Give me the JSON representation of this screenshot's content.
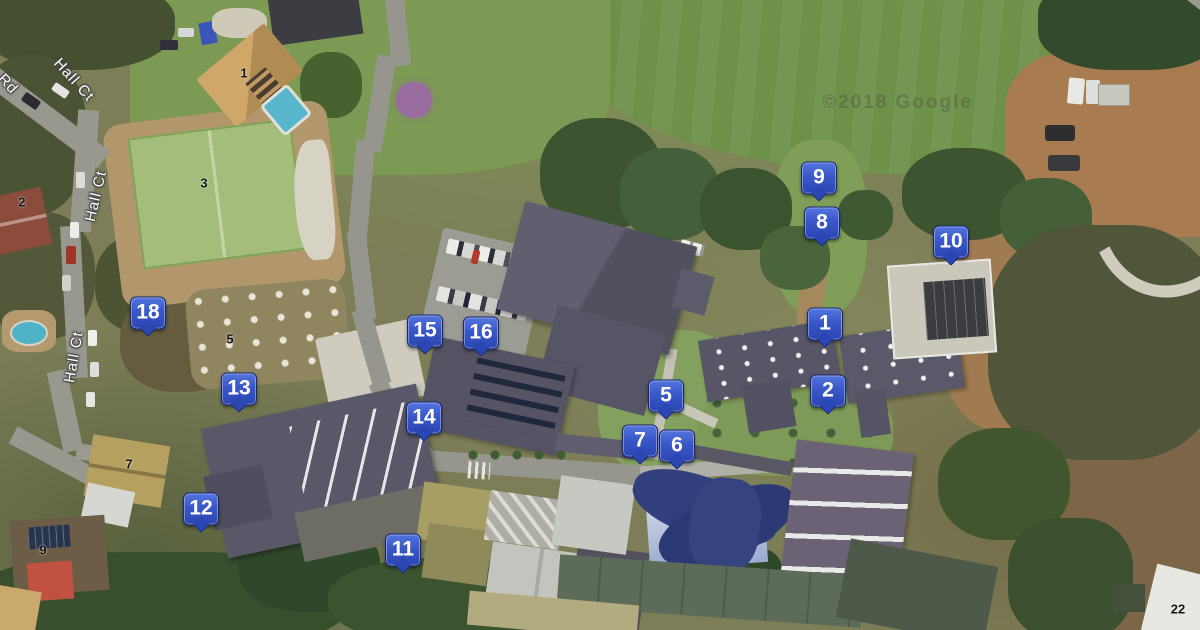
{
  "map": {
    "description": "Aerial satellite campus map with numbered blue location markers",
    "watermark": "©2018 Google",
    "marker_style": {
      "fill_top": "#5374de",
      "fill_bottom": "#2a46b2",
      "border": "#182a6e",
      "text_color": "#ffffff"
    },
    "markers": [
      {
        "label": "1",
        "x": 825,
        "y": 324
      },
      {
        "label": "2",
        "x": 828,
        "y": 391
      },
      {
        "label": "5",
        "x": 666,
        "y": 396
      },
      {
        "label": "6",
        "x": 677,
        "y": 446
      },
      {
        "label": "7",
        "x": 640,
        "y": 441
      },
      {
        "label": "8",
        "x": 822,
        "y": 223
      },
      {
        "label": "9",
        "x": 819,
        "y": 178
      },
      {
        "label": "10",
        "x": 951,
        "y": 242
      },
      {
        "label": "11",
        "x": 403,
        "y": 550
      },
      {
        "label": "12",
        "x": 201,
        "y": 509
      },
      {
        "label": "13",
        "x": 239,
        "y": 389
      },
      {
        "label": "14",
        "x": 424,
        "y": 418
      },
      {
        "label": "15",
        "x": 425,
        "y": 331
      },
      {
        "label": "16",
        "x": 481,
        "y": 333
      },
      {
        "label": "18",
        "x": 148,
        "y": 313
      }
    ],
    "road_labels": [
      {
        "text": "Rd",
        "x": 8,
        "y": 84,
        "rotation": 47
      },
      {
        "text": "Hall Ct",
        "x": 74,
        "y": 80,
        "rotation": 48
      },
      {
        "text": "Hall Ct",
        "x": 96,
        "y": 196,
        "rotation": -77
      },
      {
        "text": "Hall Ct",
        "x": 74,
        "y": 357,
        "rotation": -80
      }
    ],
    "address_labels": [
      {
        "text": "1",
        "x": 244,
        "y": 73
      },
      {
        "text": "2",
        "x": 22,
        "y": 202
      },
      {
        "text": "3",
        "x": 204,
        "y": 183
      },
      {
        "text": "5",
        "x": 230,
        "y": 339
      },
      {
        "text": "7",
        "x": 129,
        "y": 464
      },
      {
        "text": "9",
        "x": 43,
        "y": 550
      },
      {
        "text": "22",
        "x": 1178,
        "y": 609
      }
    ]
  }
}
